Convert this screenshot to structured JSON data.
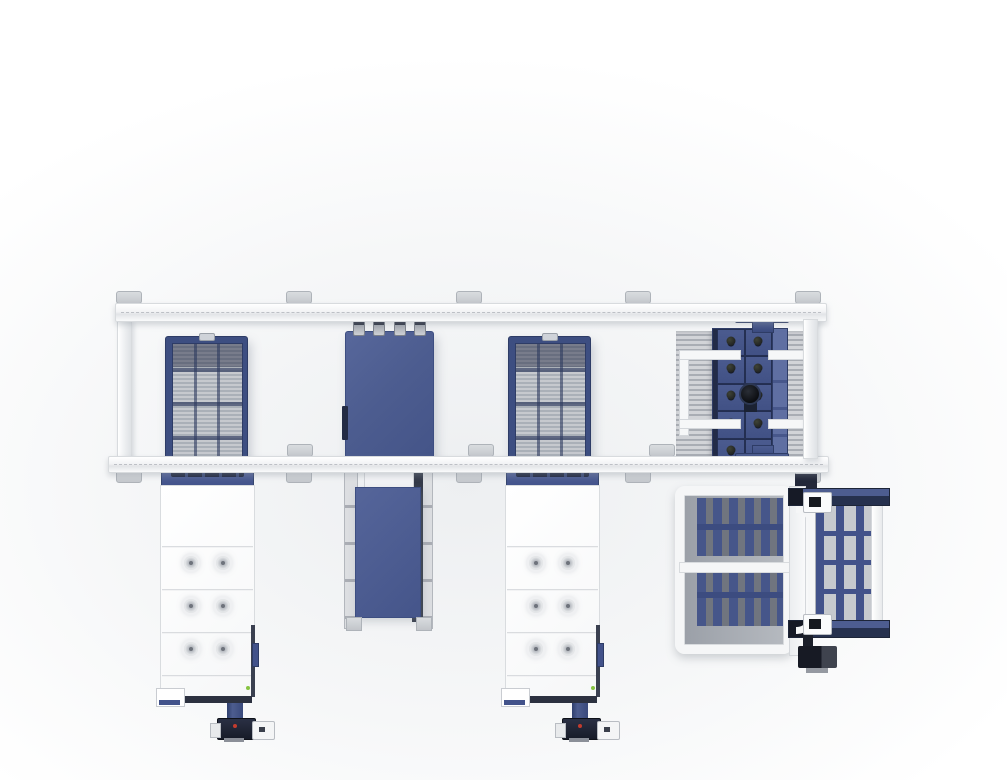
{
  "meta": {
    "description": "Top view 3D render of an automated laser cutting production line: overhead transfer gantry with two slat pallets, one raw sheet shuttle plate and a comb-fork loader-unloader on the rails; two white laser machine cabinets, a shuttle conveyor and a pallet changer exchange table below",
    "canvas": {
      "width": 1007,
      "height": 780
    }
  },
  "colors": {
    "bgGray": "#edeff1",
    "blueMain": "#4d5d90",
    "blueFrame": "#3d4e81",
    "blueDeep": "#2e3c66",
    "navy": "#232b44",
    "slatLight": "#c6c9ce",
    "slatDark": "#aab0b8",
    "teethLight": "#d2d4d8",
    "teethDark": "#a9adb4",
    "footGray": "#c5c8cd",
    "machineWhite": "#ffffff",
    "darkPanel": "#2c3140",
    "motorBlack": "#171a24",
    "redDot": "#c23b2e",
    "greenDot": "#86c341"
  },
  "scene": {
    "gantry": {
      "label": "overhead transfer gantry",
      "rails": 2,
      "posts": 2
    },
    "machines": [
      {
        "id": "pallet-grid-1",
        "label": "slat pallet with grid bed (left)"
      },
      {
        "id": "sheet-plate",
        "label": "raw sheet shuttle plate (center)"
      },
      {
        "id": "pallet-grid-2",
        "label": "slat pallet with grid bed (right)"
      },
      {
        "id": "fork-unloader",
        "label": "comb fork loader-unloader"
      },
      {
        "id": "laser-cabinet-1",
        "label": "laser machine cabinet (left)"
      },
      {
        "id": "laser-cabinet-2",
        "label": "laser machine cabinet (right)"
      },
      {
        "id": "shuttle-conveyor",
        "label": "shuttle pallet conveyor"
      },
      {
        "id": "pallet-changer",
        "label": "pallet changer exchange table"
      }
    ],
    "counts": {
      "feetMain": 5,
      "feetMid": 3,
      "forkCells": 10,
      "cabinetVents": 6,
      "plateNubs": 4,
      "ladderRungs": 3
    }
  }
}
